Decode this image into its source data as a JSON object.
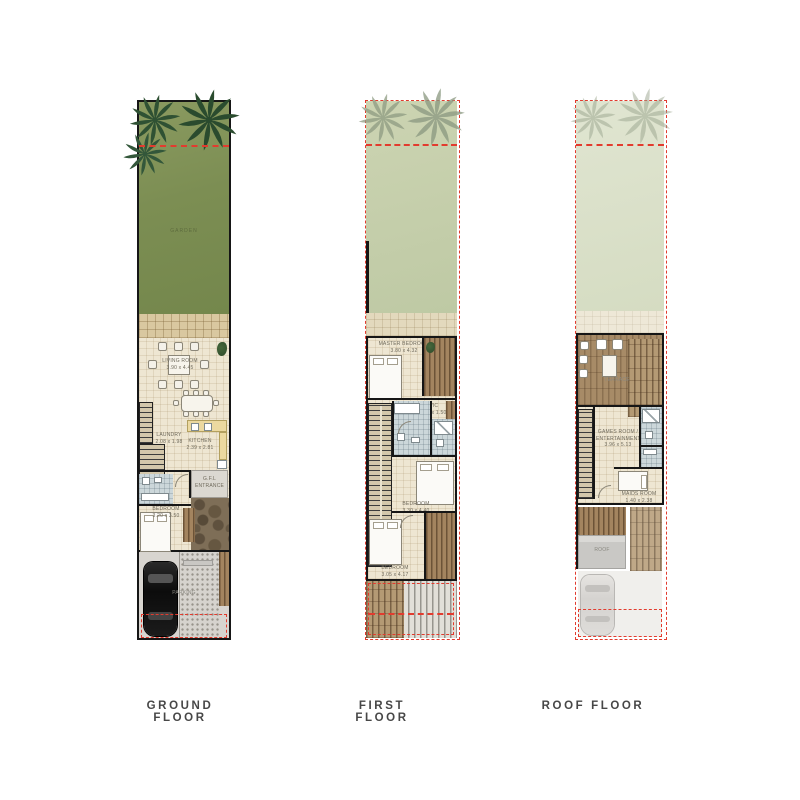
{
  "title": "Townhouse floor plans",
  "colors": {
    "wall": "#161616",
    "red_dash": "#e23b2e",
    "garden_green": "#7f9155",
    "garden_faded": "#c7d0ac",
    "garden_faint": "#dde3cd",
    "deck_brown": "#a3845f",
    "interior_cream": "#eee6d2"
  },
  "floors": [
    {
      "id": "ground-floor",
      "label": "GROUND FLOOR",
      "rooms": {
        "garden": {
          "line1": "GARDEN",
          "line2": ""
        },
        "living": {
          "line1": "LIVING ROOM",
          "line2": "3.90 x 4.45"
        },
        "laundry": {
          "line1": "LAUNDRY",
          "line2": "2.08 x 1.98"
        },
        "kitchen": {
          "line1": "KITCHEN",
          "line2": "2.39 x 2.81"
        },
        "entrance": {
          "line1": "G.F.L",
          "line2": "ENTRANCE"
        },
        "bedroom": {
          "line1": "BEDROOM",
          "line2": "3.20 x 3.50"
        },
        "parking": {
          "line1": "PARKING",
          "line2": ""
        }
      }
    },
    {
      "id": "first-floor",
      "label": "FIRST FLOOR",
      "rooms": {
        "master": {
          "line1": "MASTER BEDROOM",
          "line2": "3.80 x 4.32"
        },
        "wic": {
          "line1": "WIC",
          "line2": "2.10 x 1.50"
        },
        "bedroom1": {
          "line1": "BEDROOM",
          "line2": "3.30 x 4.40"
        },
        "bedroom2": {
          "line1": "BEDROOM",
          "line2": "3.05 x 4.17"
        }
      }
    },
    {
      "id": "roof-floor",
      "label": "ROOF FLOOR",
      "rooms": {
        "terrace": {
          "line1": "TERRACE",
          "line2": ""
        },
        "games": {
          "line1": "GAMES ROOM /",
          "line2": "ENTERTAINMENT",
          "line3": "3.96 x 5.13"
        },
        "maids": {
          "line1": "MAIDS ROOM",
          "line2": "1.40 x 2.38"
        },
        "roof": {
          "line1": "ROOF",
          "line2": ""
        }
      }
    }
  ]
}
